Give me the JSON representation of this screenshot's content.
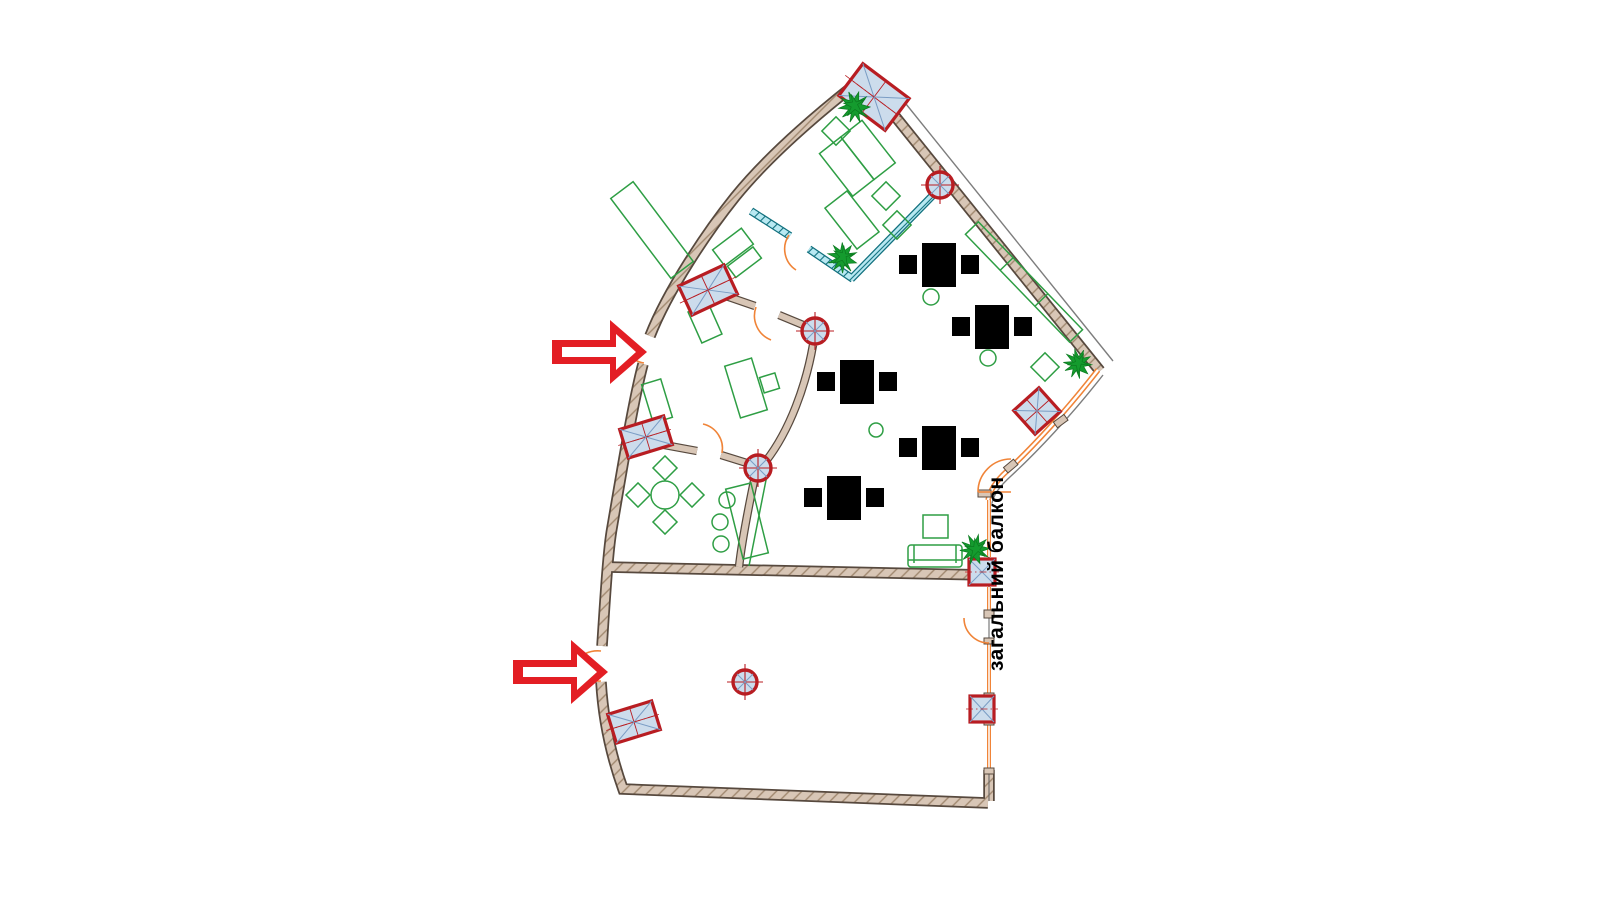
{
  "labels": {
    "common_balcony": "загальний балкон"
  },
  "colors": {
    "background": "#ffffff",
    "wall": "#d8c6b6",
    "wall_outline": "#57493e",
    "hatch_line": "#a0886f",
    "partition": "#b8e9f2",
    "partition_edge": "#11707e",
    "furniture": "#2e9e44",
    "door": "#f08438",
    "window": "#f08438",
    "shaft_fill": "#ccdcec",
    "shaft_border": "#b81d22",
    "column_marker": "#b81d22",
    "arrow": "#e31e24",
    "plant": "#149b2e",
    "label_text": "#000000"
  },
  "elements": {
    "entrance_arrows": 2,
    "shaft_columns": 7,
    "round_columns": 4,
    "plants": 4,
    "desk_groups": 7
  }
}
